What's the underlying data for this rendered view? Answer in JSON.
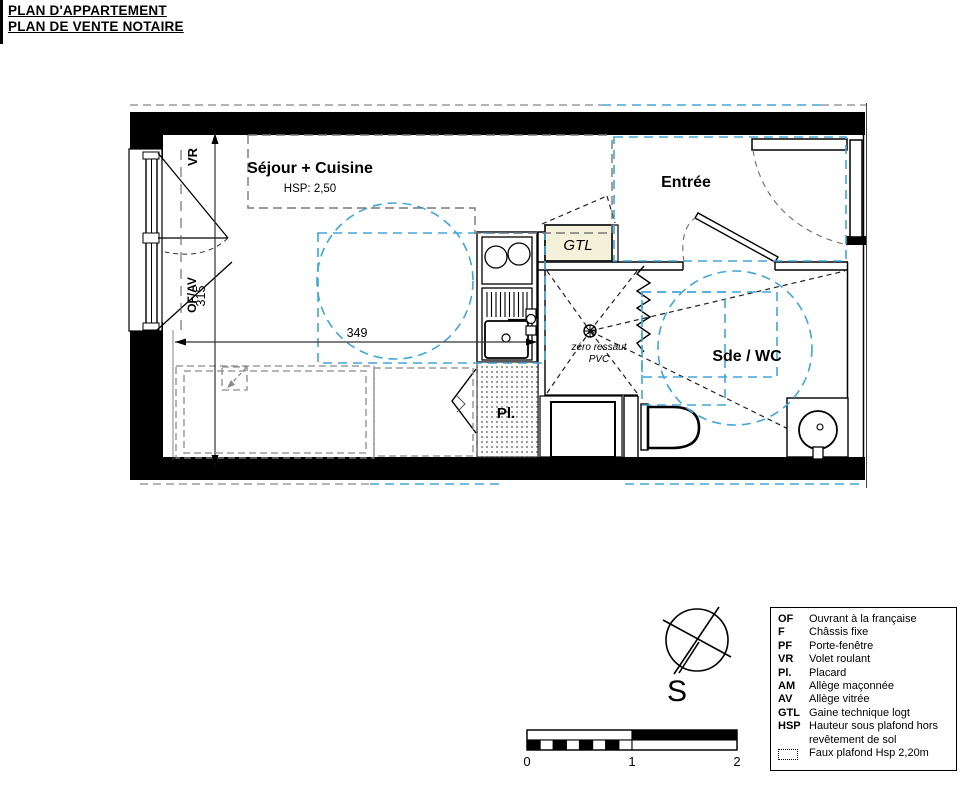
{
  "header": {
    "line1": "PLAN D'APPARTEMENT",
    "line2": "PLAN DE VENTE NOTAIRE"
  },
  "plan": {
    "rooms": {
      "sejour": {
        "label": "Séjour + Cuisine",
        "hsp": "HSP: 2,50"
      },
      "entree": {
        "label": "Entrée"
      },
      "sde_wc": {
        "label": "Sde / WC"
      },
      "placard": {
        "label": "Pl."
      },
      "gtl": {
        "label": "GTL"
      }
    },
    "annotations": {
      "shower_line1": "zéro ressaut",
      "shower_line2": "PVC"
    },
    "dimensions": {
      "width": "349",
      "height": "315"
    },
    "window_labels": {
      "top": "VR",
      "bottom": "OF/AV"
    },
    "colors": {
      "accessibility_blue": "#41A6D8",
      "wall_black": "#000000",
      "gtl_fill": "#F4F1DA",
      "furniture_gray": "#8a8a8a"
    }
  },
  "compass": {
    "south_label": "S"
  },
  "scale_bar": {
    "labels": [
      "0",
      "1",
      "2"
    ]
  },
  "legend": {
    "items": [
      {
        "abbr": "OF",
        "label": "Ouvrant à la française"
      },
      {
        "abbr": "F",
        "label": "Châssis fixe"
      },
      {
        "abbr": "PF",
        "label": "Porte-fenêtre"
      },
      {
        "abbr": "VR",
        "label": "Volet roulant"
      },
      {
        "abbr": "Pl.",
        "label": "Placard"
      },
      {
        "abbr": "AM",
        "label": "Allège maçonnée"
      },
      {
        "abbr": "AV",
        "label": "Allège vitrée"
      },
      {
        "abbr": "GTL",
        "label": "Gaine technique logt"
      },
      {
        "abbr": "HSP",
        "label": "Hauteur sous plafond hors"
      },
      {
        "abbr": "",
        "label": "revêtement de sol"
      },
      {
        "abbr": "",
        "label": "Faux plafond Hsp 2,20m"
      }
    ]
  }
}
